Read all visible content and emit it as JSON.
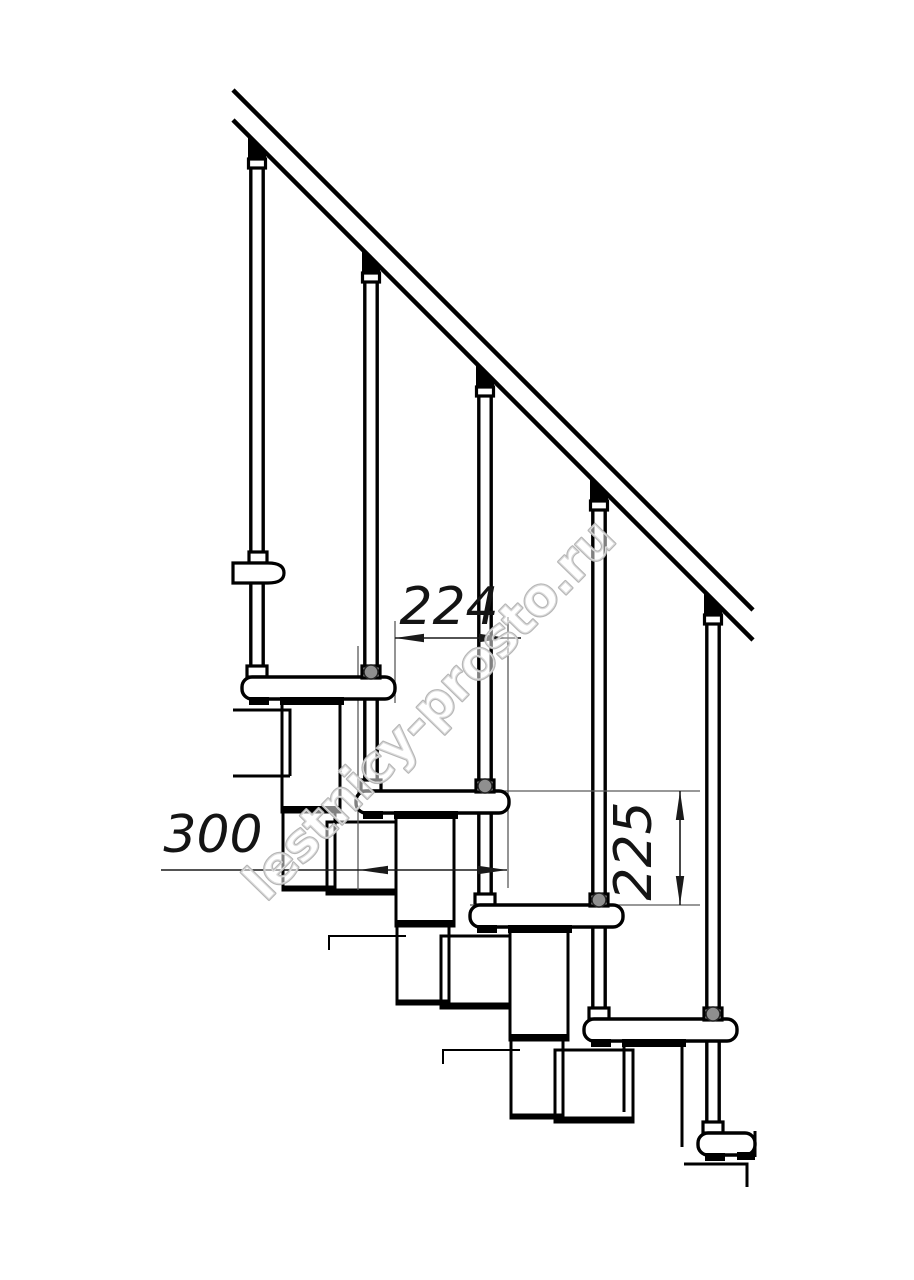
{
  "drawing": {
    "subject": "modular staircase side elevation",
    "background": "#ffffff",
    "line_color": "#000000",
    "labels": {
      "run": "224",
      "tread_depth": "300",
      "rise": "225"
    },
    "watermark": {
      "text": "lestnicy-prosto.ru",
      "outline_color": "#b6b6b6"
    },
    "parts": {
      "handrail_count": 1,
      "baluster_count": 5,
      "tread_count": 5,
      "support_module_count": 4
    }
  }
}
